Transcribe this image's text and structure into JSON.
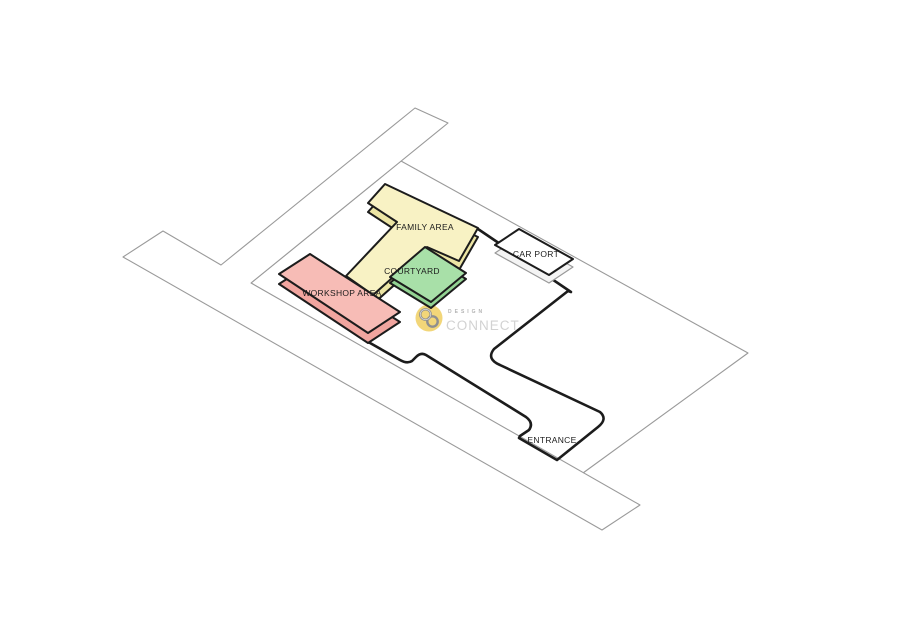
{
  "diagram": {
    "type": "axonometric-site-plan",
    "areas": {
      "family": {
        "label": "FAMILY AREA",
        "fill": "#f8f2c4",
        "side": "#ece5a4"
      },
      "courtyard": {
        "label": "COURTYARD",
        "fill": "#a8e0a8",
        "side": "#93d393"
      },
      "workshop": {
        "label": "WORKSHOP AREA",
        "fill": "#f7bcb6",
        "side": "#f1a59f"
      },
      "carport": {
        "label": "CAR PORT",
        "fill": "#ffffff",
        "side": "#f4f4f4"
      },
      "entrance": {
        "label": "ENTRANCE"
      }
    },
    "watermark": {
      "brand_top": "DESIGN",
      "brand_bottom": "CONNECT",
      "badge_color": "#f2d679",
      "glyph_color": "#8f8f8f",
      "glyph": "interlocked-rings"
    },
    "colors": {
      "background": "#ffffff",
      "plot_outline": "#1c1c1c",
      "boundary_line": "#9a9a9a",
      "label_text": "#1c1c1c"
    }
  }
}
